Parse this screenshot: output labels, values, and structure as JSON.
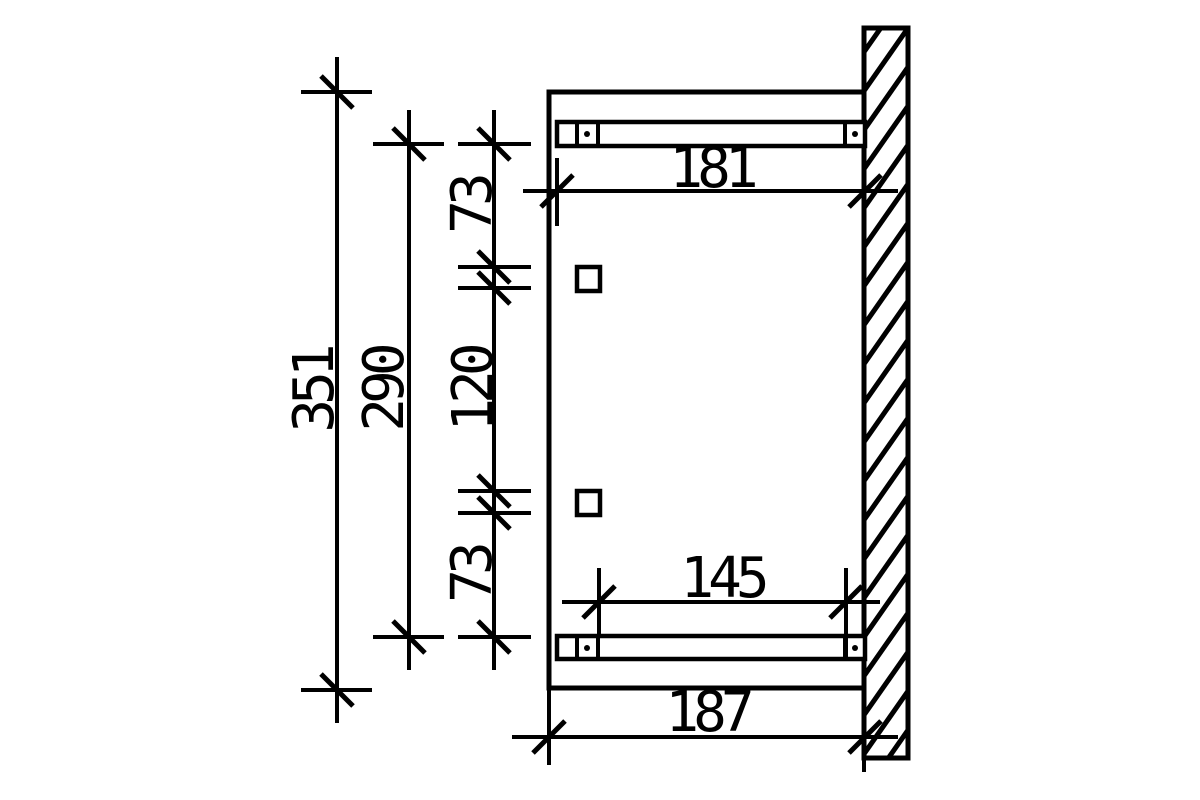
{
  "drawing": {
    "description": "technical-dimension-drawing",
    "colors": {
      "line": "#000000",
      "background": "#ffffff"
    },
    "dimensions": {
      "overall_height": "351",
      "bracket_height": "290",
      "upper_offset": "73",
      "bolt_spacing": "120",
      "lower_offset": "73",
      "upper_rafter_length": "181",
      "lower_rafter_spacing": "145",
      "overall_depth": "187"
    }
  }
}
